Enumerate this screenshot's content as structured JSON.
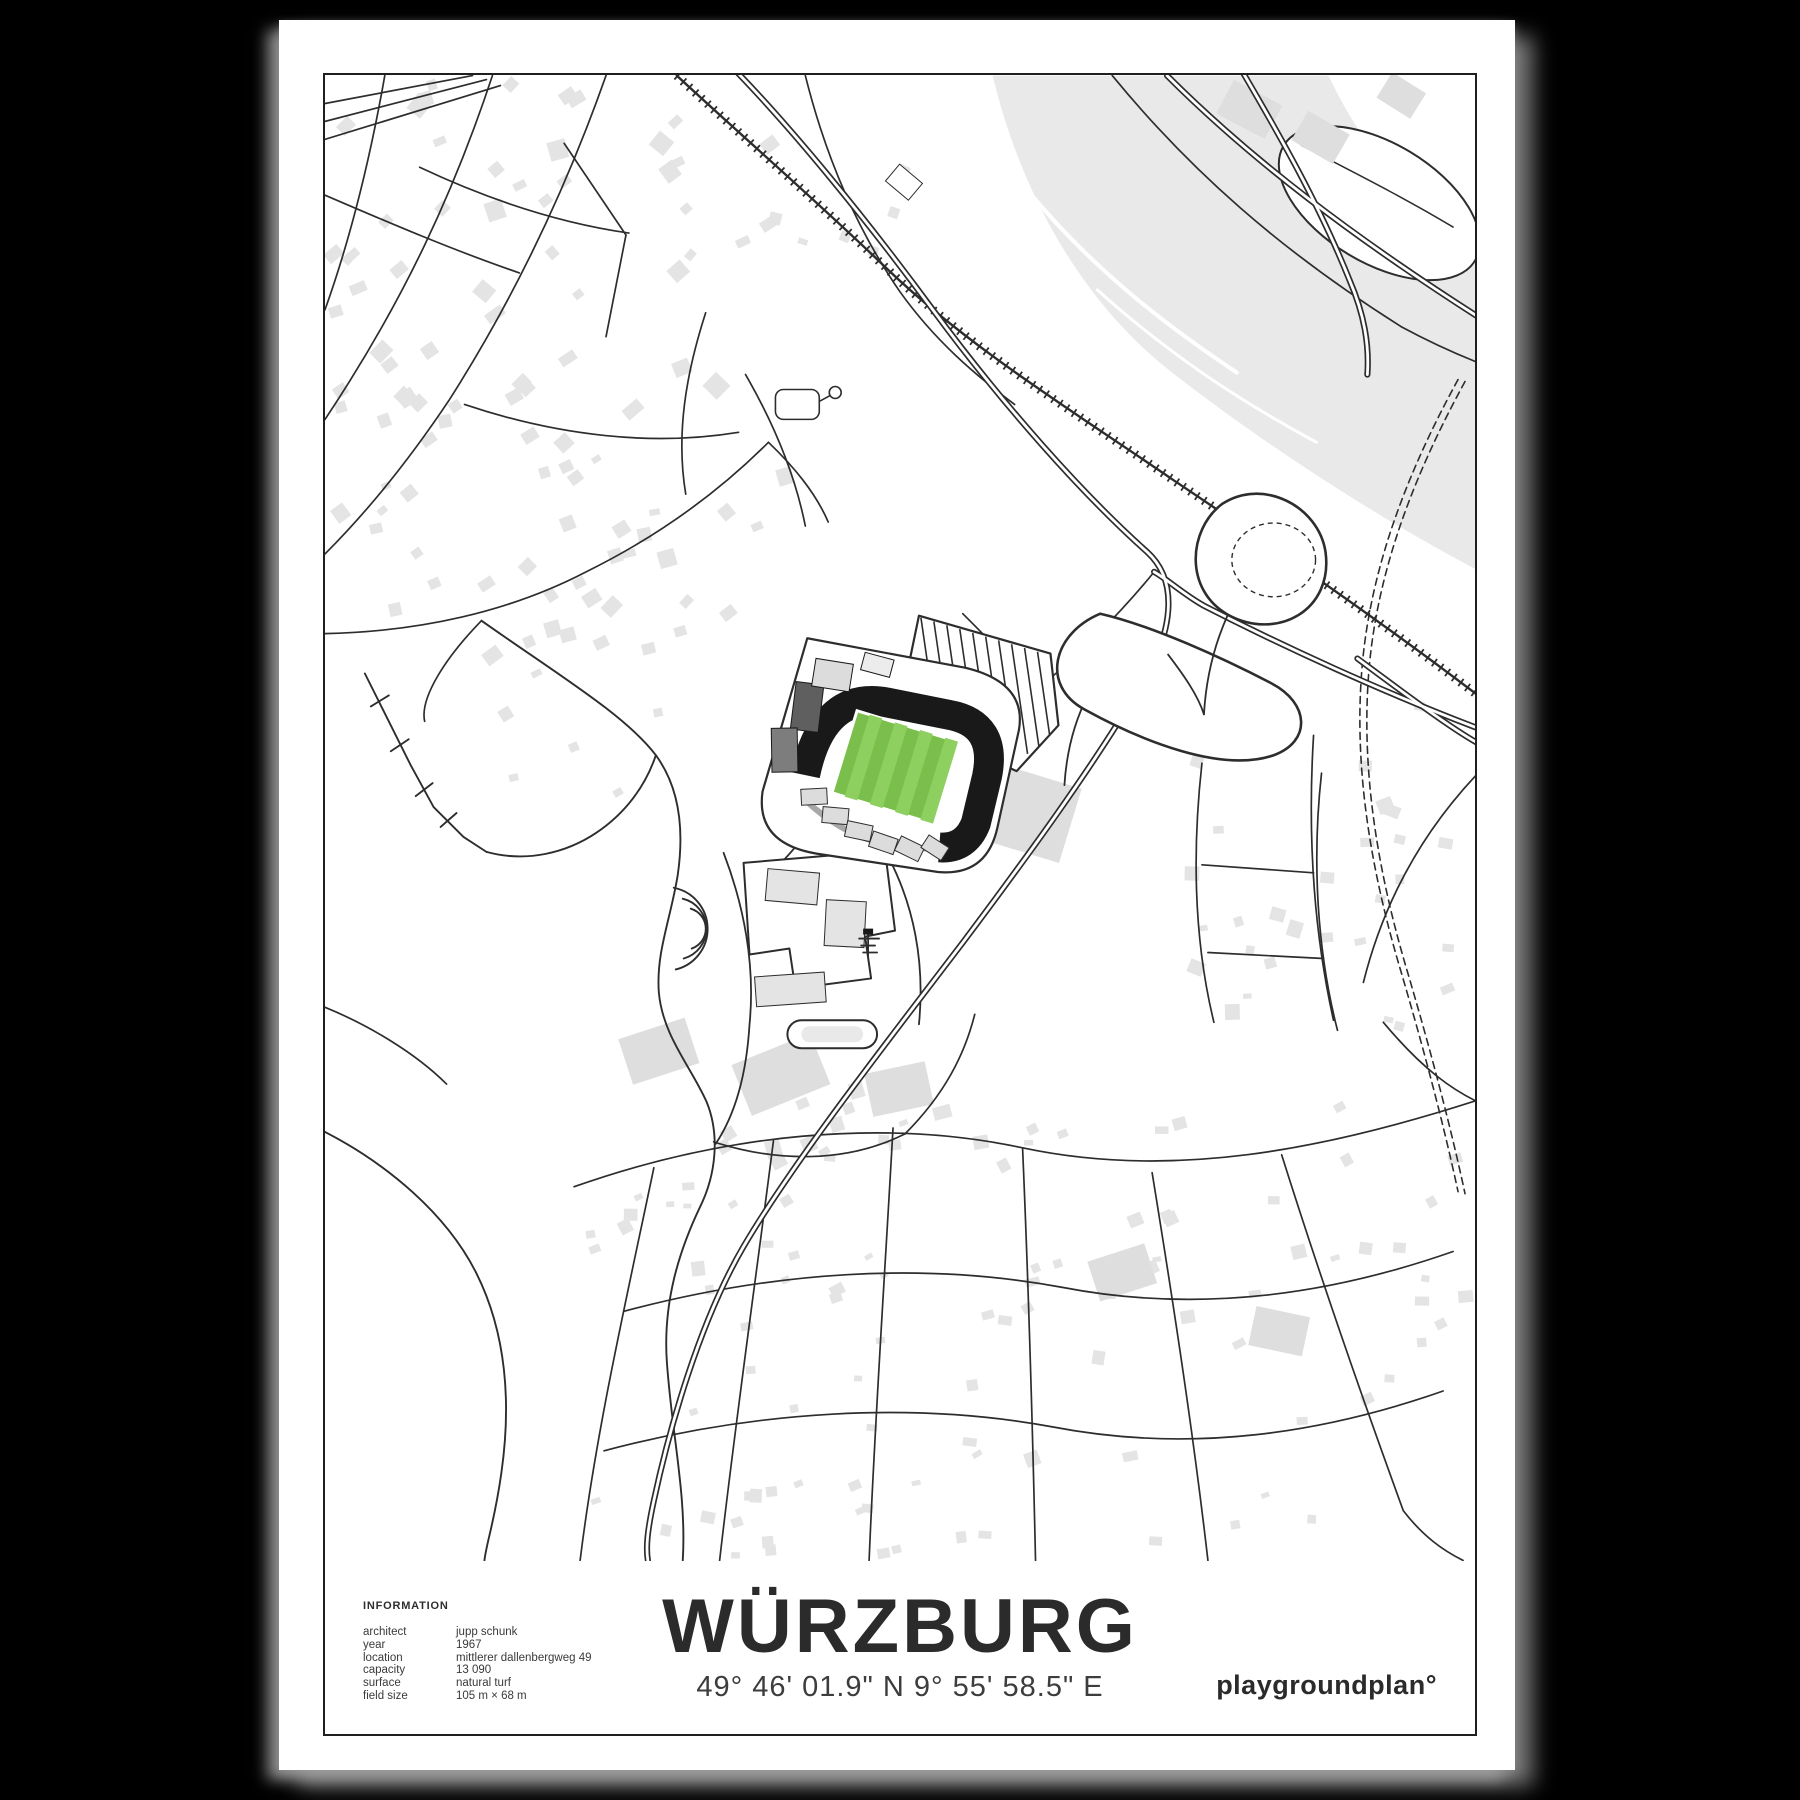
{
  "poster": {
    "title": "WÜRZBURG",
    "coordinates": "49° 46' 01.9\" N 9° 55' 58.5\" E",
    "brand": "playgroundplan°",
    "info": {
      "heading": "INFORMATION",
      "rows": [
        {
          "label": "architect",
          "value": "jupp schunk"
        },
        {
          "label": "year",
          "value": "1967"
        },
        {
          "label": "location",
          "value": "mittlerer dallenbergweg 49"
        },
        {
          "label": "capacity",
          "value": "13 090"
        },
        {
          "label": "surface",
          "value": "natural turf"
        },
        {
          "label": "field size",
          "value": "105 m × 68 m"
        }
      ]
    }
  },
  "map": {
    "subject": "stadium city map of würzburg (dallenberg stadium)",
    "palette": {
      "bg": "#000000",
      "paper": "#ffffff",
      "line": "#2d2d2d",
      "building": "#e4e4e4",
      "water": "#e9e9e9",
      "pitch_green": "#7abf4b",
      "pitch_stripe": "#8ed05f",
      "stand_black": "#191919",
      "stand_gray_dark": "#5f5f5f",
      "stand_gray_mid": "#7d7d7d",
      "stand_gray_light": "#dcdcdc"
    }
  }
}
